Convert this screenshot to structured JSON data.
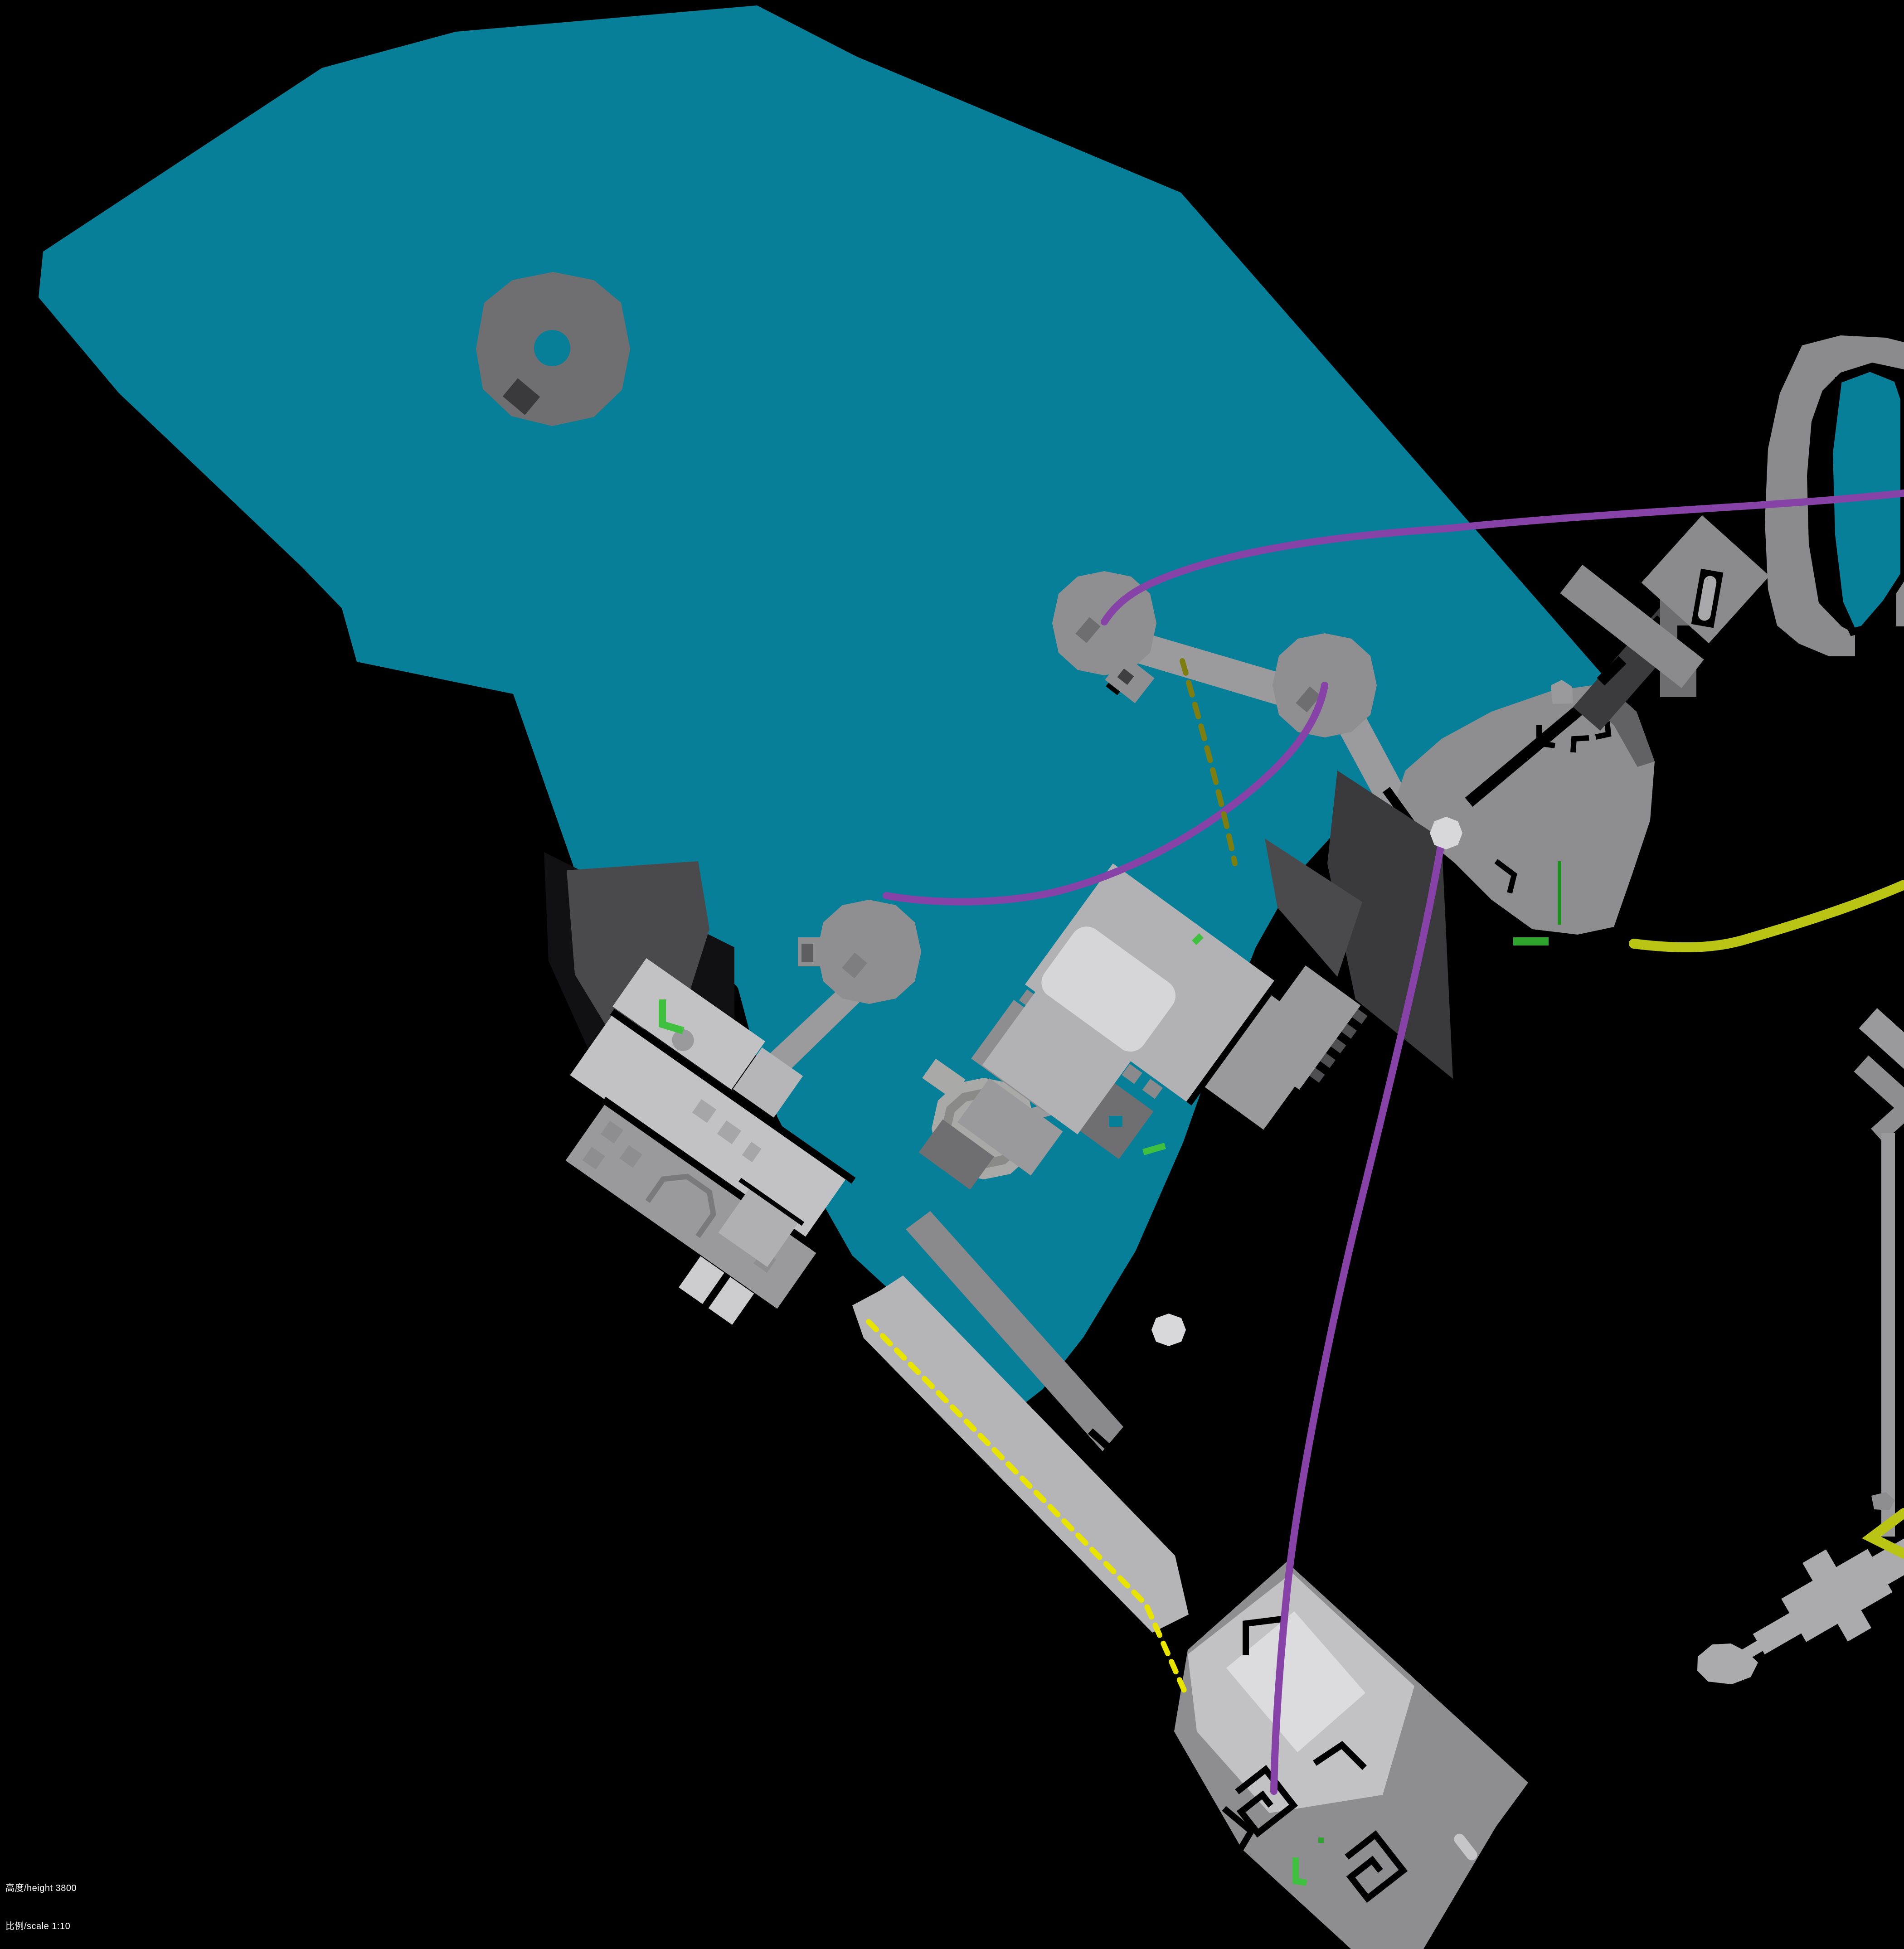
{
  "caption": {
    "height_label": "高度/height 3800",
    "scale_label": "比例/scale 1:10"
  },
  "colors": {
    "background": "#000000",
    "water": "#087F99",
    "donut_gray": "#6F6F71",
    "platform_gray": "#8F8F91",
    "bridge_gray": "#9B9B9D",
    "land_gray": "#8E8E90",
    "light_gray": "#C2C2C4",
    "white_gray": "#DCDCDE",
    "mid_gray": "#9A9A9C",
    "dark_gray": "#6E6E70",
    "cove_gray": "#4A4A4C",
    "road_dark": "#3B3B3D",
    "pier_gray": "#B5B5B7",
    "sword_gray": "#ABABAD",
    "purple_route": "#8742A8",
    "yellow_route": "#B9C414",
    "yellow_dashed": "#E8E400",
    "olive_dashed": "#7E7E10",
    "green_marker": "#3FC13F",
    "green_dark_marker": "#1E8F1E",
    "node_white": "#D8D8DA"
  }
}
